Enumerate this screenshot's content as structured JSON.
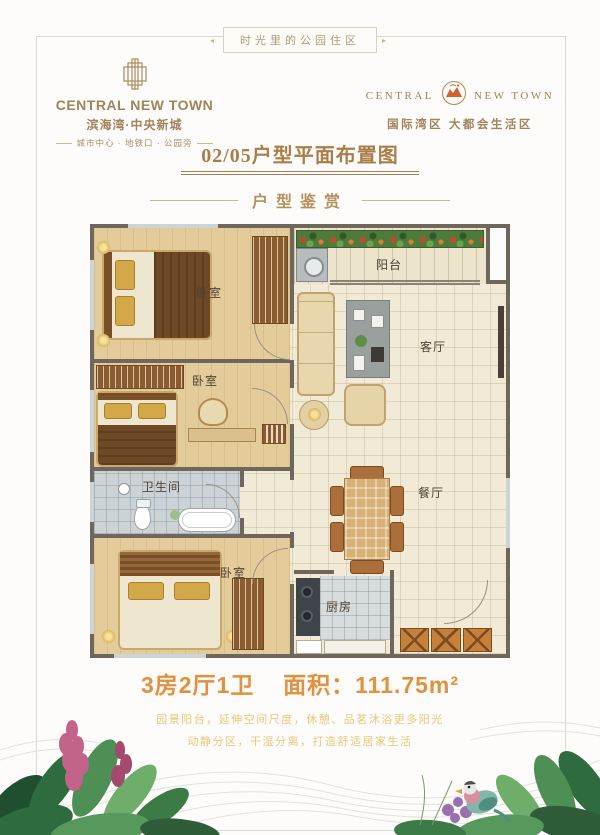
{
  "banner": {
    "text": "时光里的公园住区"
  },
  "brand_left": {
    "name_en": "CENTRAL NEW TOWN",
    "name_cn": "滨海湾·中央新城",
    "tagline": "城市中心 · 地铁口 · 公园旁"
  },
  "brand_right": {
    "name_en_left": "CENTRAL",
    "name_en_right": "NEW TOWN",
    "subtitle": "国际湾区  大都会生活区"
  },
  "page": {
    "title": "02/05户型平面布置图",
    "section_header": "户型鉴赏"
  },
  "floorplan": {
    "rooms": {
      "bedroom_top": "卧室",
      "bedroom_mid": "卧室",
      "bedroom_bottom": "卧室",
      "balcony": "阳台",
      "living": "客厅",
      "dining": "餐厅",
      "bathroom": "卫生间",
      "kitchen": "厨房"
    }
  },
  "summary": {
    "spec": "3房2厅1卫",
    "area_label": "面积：",
    "area_value": "111.75m²"
  },
  "description": {
    "line1": "园景阳台，延伸空间尺度，休憩、品茗沐浴更多阳光",
    "line2": "动静分区，干湿分离，打造舒适居家生活"
  },
  "icons": {
    "brand_building": "building-icon",
    "brand_emblem": "emblem-icon",
    "foliage_left": "foliage-left",
    "foliage_right": "foliage-right",
    "bird": "bird-icon",
    "waves": "wave-pattern"
  },
  "colors": {
    "brand_gold": "#a1835c",
    "title_brown": "#aa7e49",
    "header_gold": "#b5905e",
    "area_orange": "#e2913f",
    "description_gold": "#e8c87b",
    "wall": "#6f665c",
    "floor_cream": "#f1ead6",
    "floor_tan": "#e3cc99",
    "tile_gray": "#d7dcdd",
    "plant_green": "#4e7a3c",
    "flower_red": "#c9452a"
  }
}
